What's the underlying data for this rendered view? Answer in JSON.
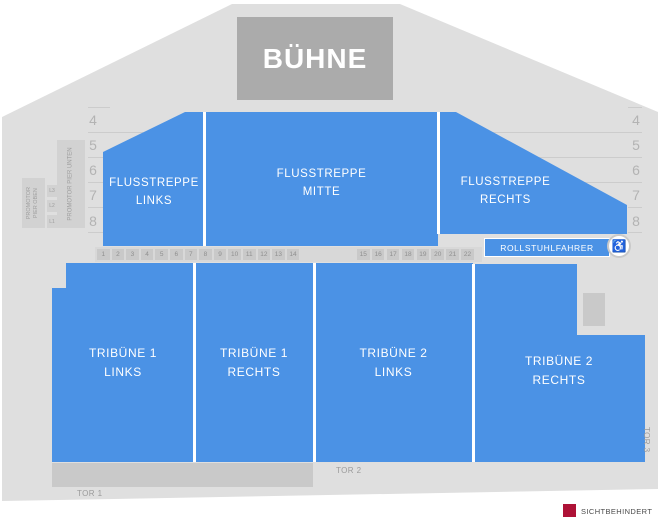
{
  "stage": {
    "label": "BÜHNE"
  },
  "sections": {
    "flusstreppe_links": {
      "line1": "FLUSSTREPPE",
      "line2": "LINKS"
    },
    "flusstreppe_mitte": {
      "line1": "FLUSSTREPPE",
      "line2": "MITTE"
    },
    "flusstreppe_rechts": {
      "line1": "FLUSSTREPPE",
      "line2": "RECHTS"
    },
    "tribuene_1_links": {
      "line1": "TRIBÜNE 1",
      "line2": "LINKS"
    },
    "tribuene_1_rechts": {
      "line1": "TRIBÜNE 1",
      "line2": "RECHTS"
    },
    "tribuene_2_links": {
      "line1": "TRIBÜNE 2",
      "line2": "LINKS"
    },
    "tribuene_2_rechts": {
      "line1": "TRIBÜNE 2",
      "line2": "RECHTS"
    },
    "rollstuhlfahrer": {
      "label": "ROLLSTUHLFAHRER"
    }
  },
  "promotor": {
    "oben": "PROMOTOR PIER OBEN",
    "unten": "PROMOTOR PIER UNTEN",
    "levels": [
      "L3",
      "L2",
      "L1"
    ]
  },
  "rows": {
    "left": [
      "4",
      "5",
      "6",
      "7",
      "8"
    ],
    "right": [
      "4",
      "5",
      "6",
      "7",
      "8"
    ]
  },
  "seats": {
    "group1": [
      "1",
      "2",
      "3",
      "4",
      "5",
      "6",
      "7",
      "8",
      "9",
      "10",
      "11",
      "12",
      "13",
      "14"
    ],
    "group2": [
      "15",
      "16",
      "17",
      "18",
      "19",
      "20",
      "21",
      "22"
    ]
  },
  "gates": {
    "tor1": "TOR 1",
    "tor2": "TOR 2",
    "tor3": "TOR 3"
  },
  "legend": {
    "sichtbehindert": "SICHTBEHINDERT"
  },
  "colors": {
    "section_blue": "#4b92e5",
    "floor_gray": "#dfdfdf",
    "stage_gray": "#ababab",
    "legend_red": "#ae1237"
  }
}
